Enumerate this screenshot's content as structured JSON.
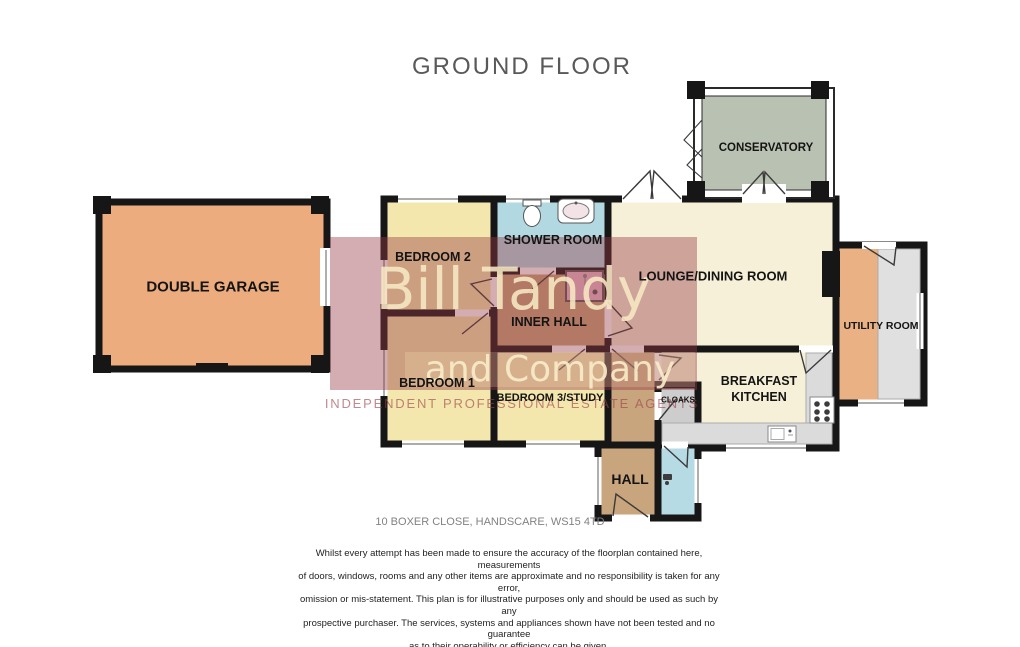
{
  "title": "GROUND FLOOR",
  "rooms": {
    "garage": {
      "label": "DOUBLE GARAGE"
    },
    "bedroom2": {
      "label": "BEDROOM 2"
    },
    "shower_room": {
      "label": "SHOWER ROOM"
    },
    "inner_hall": {
      "label": "INNER HALL"
    },
    "bedroom1": {
      "label": "BEDROOM 1"
    },
    "bedroom3": {
      "label": "BEDROOM 3/STUDY"
    },
    "lounge_dining": {
      "label": "LOUNGE/DINING ROOM"
    },
    "conservatory": {
      "label": "CONSERVATORY"
    },
    "utility": {
      "label": "UTILITY ROOM"
    },
    "breakfast_kitchen": {
      "label": "BREAKFAST KITCHEN"
    },
    "cloaks": {
      "label": "CLOAKS"
    },
    "hall": {
      "label": "HALL"
    }
  },
  "watermark": {
    "line1": "Bill Tandy",
    "line2": "and Company",
    "line3": "INDEPENDENT PROFESSIONAL ESTATE AGENTS"
  },
  "address": "10 BOXER CLOSE, HANDSCARE, WS15 4TD",
  "disclaimer": "Whilst every attempt has been made to ensure the accuracy of the floorplan contained here, measurements\nof doors, windows, rooms and any other items are approximate and no responsibility is taken for any error,\nomission or mis-statement. This plan is for illustrative purposes only and should be used as such by any\nprospective purchaser. The services, systems and appliances shown have not been tested and no guarantee\nas to their operability or efficiency can be given.",
  "credit": "Made with Metropix ©2026",
  "colors": {
    "wall": "#161616",
    "watermark_maroon": "#963C46",
    "watermark_cream": "#F6E9C4",
    "garage_fill": "#ECAC7E",
    "bedroom_fill": "#F4E7AD",
    "shower_fill": "#B2D9E2",
    "hall_fill": "#C9A57D",
    "lounge_fill": "#F7F0D8",
    "conservatory_fill": "#B9C2B2",
    "utility_fill": "#EAB284",
    "cloaks_fill": "#CDCDCD",
    "wc_fill": "#B7DBE4",
    "counter_fill": "#DBDBDB",
    "shower_cubicle_fill": "#EDBACB"
  }
}
